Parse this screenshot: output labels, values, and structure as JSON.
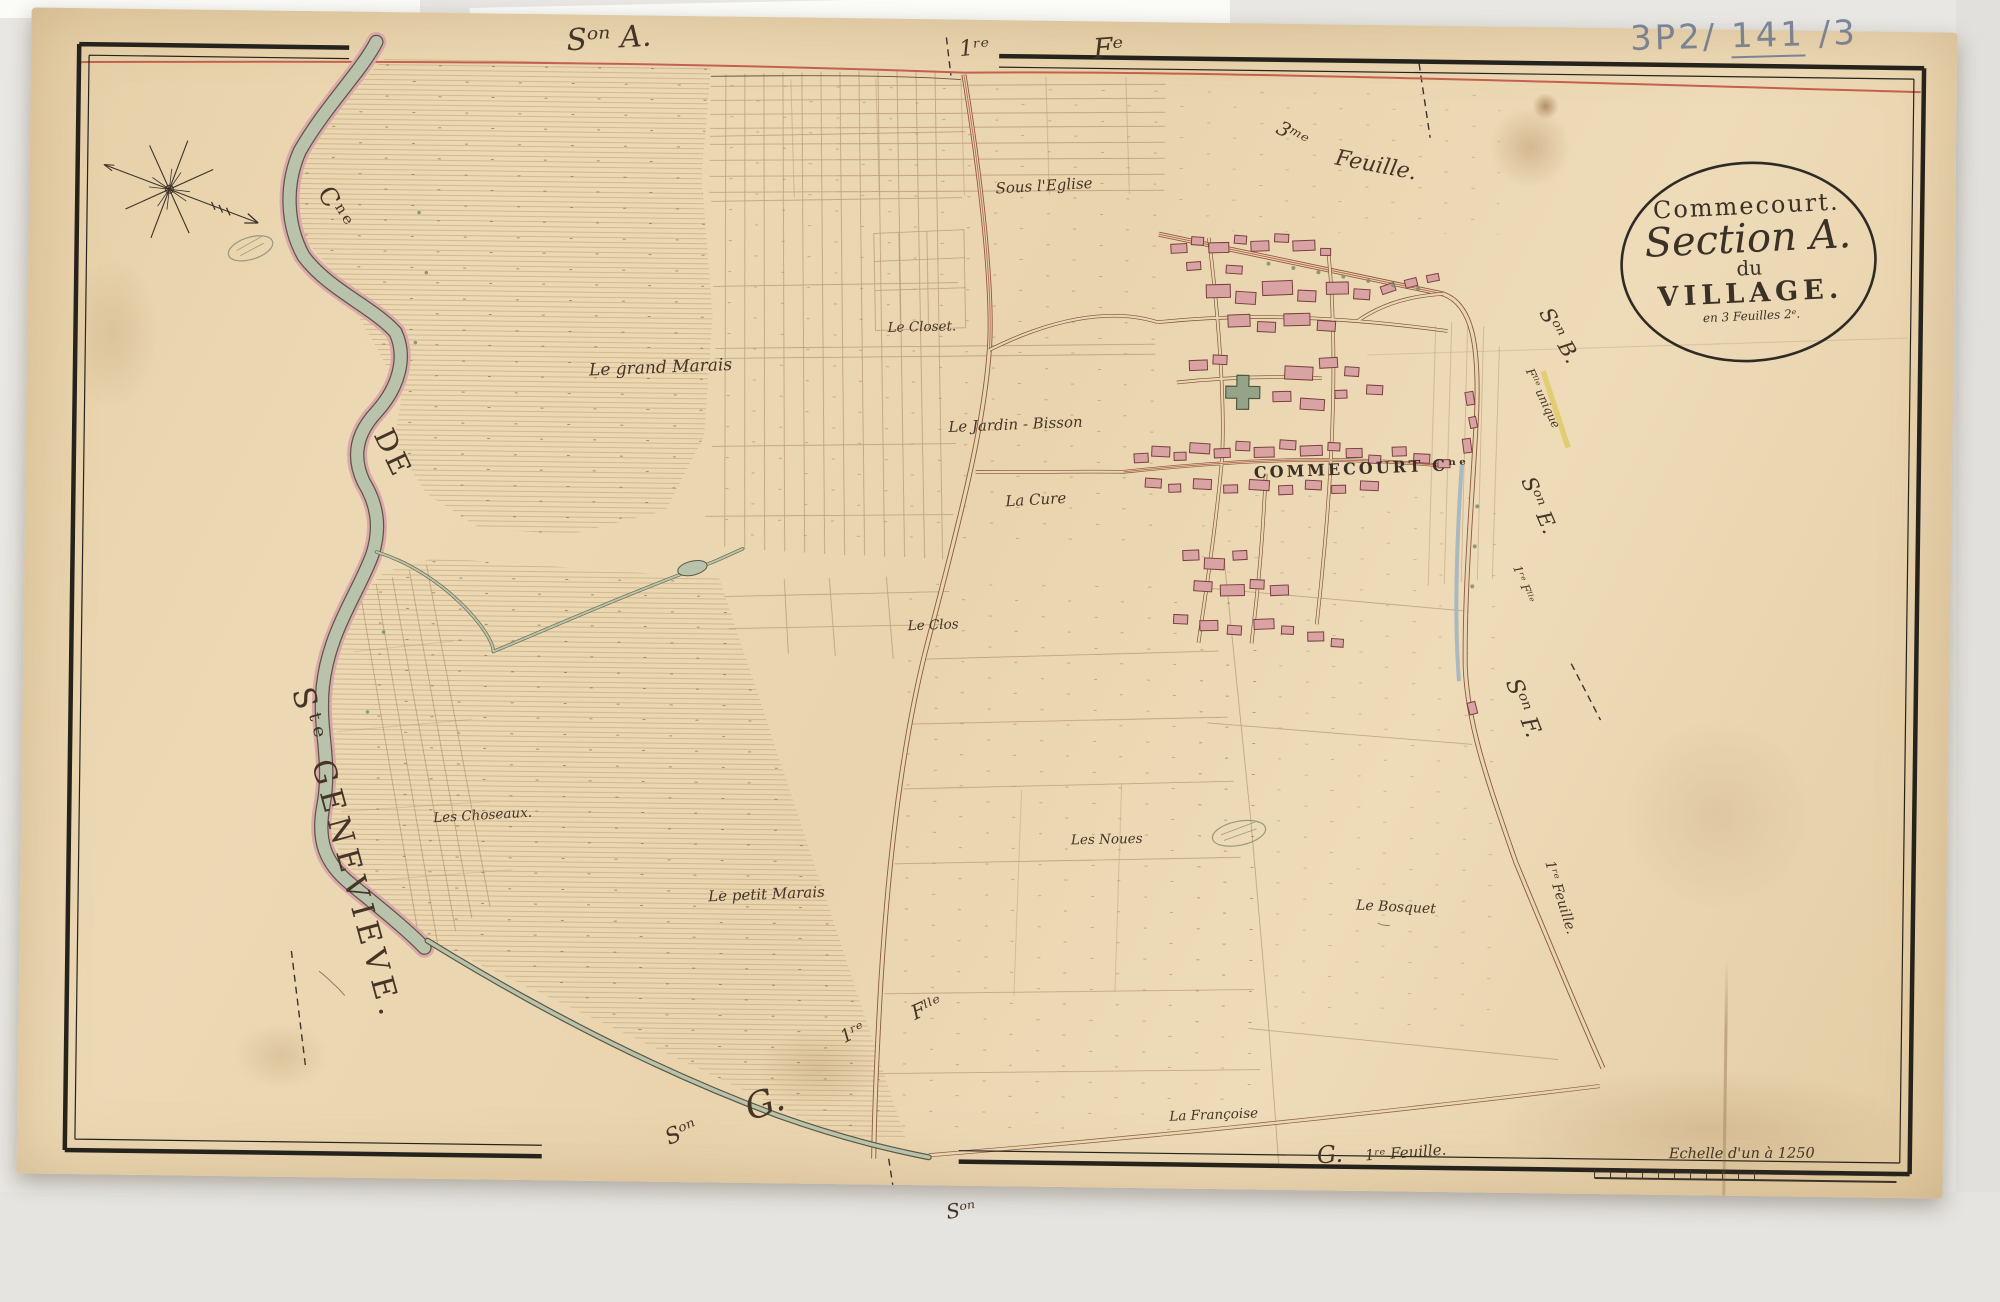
{
  "archive_ref": {
    "p1": "3P2/ ",
    "p2": "141",
    "p3": " /3"
  },
  "cartouche": {
    "line1": "Commecourt.",
    "line2": "Section A.",
    "line3": "du",
    "line4": "VILLAGE.",
    "line5": "en 3 Feuilles 2ᵉ."
  },
  "margins": {
    "top_son_a": "Sᵒⁿ A.",
    "top_1re": "1ʳᵉ",
    "top_fe": "Fᵉ",
    "feuille_3me_a": "3ᵐᵉ",
    "feuille_3me_b": "Feuille.",
    "left_cne": "Cⁿᵉ",
    "left_de": "DE",
    "left_ste_genevieve": "Sᵗᵉ GENEVIEVE.",
    "right_son_b": "Sᵒⁿ B.",
    "right_son_b_note": "Fˡˡᵉ unique",
    "right_son_e": "Sᵒⁿ E.",
    "right_son_e_note": "1ʳᵉ Fˡˡᵉ",
    "right_son_f": "Sᵒⁿ F.",
    "right_son_f_note": "1ʳᵉ Feuille.",
    "bottom_son": "Sᵒⁿ",
    "bottom_g": "G.",
    "bottom_1re": "1ʳᵉ",
    "bottom_flle": "Fˡˡᵉ",
    "bottom_right_g": "G.",
    "bottom_right_note": "1ʳᵉ Feuille.",
    "below_border_son": "Sᵒⁿ"
  },
  "places": {
    "village": "COMMECOURT Cⁿᵉ",
    "grand_marais": "Le grand Marais",
    "sous_eglise": "Sous l'Eglise",
    "closet": "Le Closet.",
    "jardin_bisson": "Le Jardin - Bisson",
    "cure": "La Cure",
    "clos": "Le Clos",
    "noues": "Les Noues",
    "petit_marais": "Le petit Marais",
    "choseaux": "Les Choseaux.",
    "bosquet": "Le Bosquet",
    "francoise": "La Françoise"
  },
  "scale": {
    "label": "Echelle d'un à 1250"
  },
  "colors": {
    "paper": "#e9d5b0",
    "ink": "#443527",
    "water_green": "#b9c3ab",
    "bank_pink": "#dca8ac",
    "building_fill": "#d9a3a3",
    "building_outline": "#7a4040",
    "road_red": "#c4614e",
    "road_yellow": "#e2cd72",
    "stream_blue": "#9fb6c2",
    "border_black": "#26221c",
    "pencil_blue": "#68768c"
  }
}
